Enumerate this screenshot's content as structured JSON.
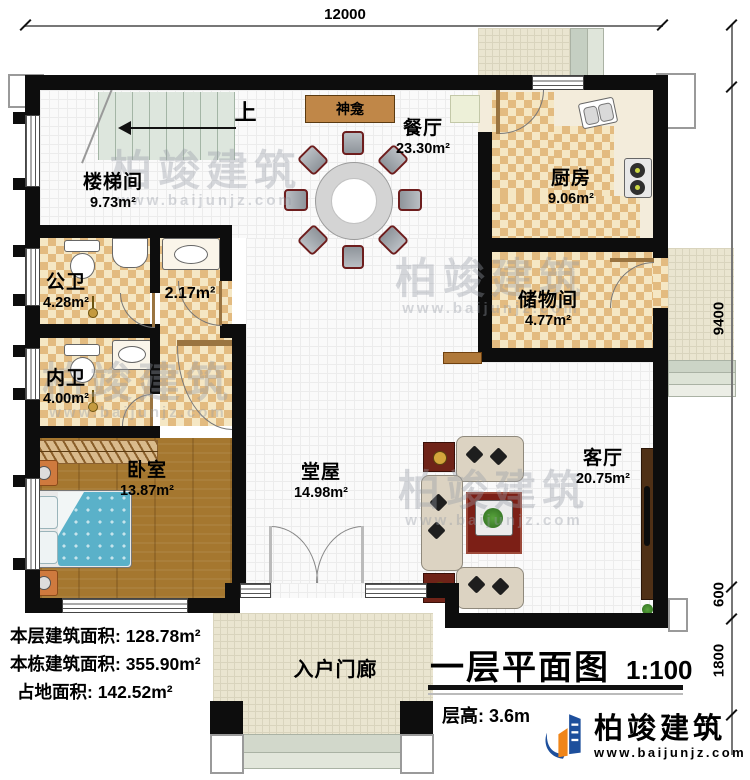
{
  "plan": {
    "title": "一层平面图",
    "scale": "1:100",
    "storey_height_label": "层高:",
    "storey_height_value": "3.6m",
    "up_label": "上",
    "shrine_label": "神龛"
  },
  "dimensions": {
    "top": "12000",
    "right_upper": "9400",
    "right_middle": "600",
    "right_lower": "1800"
  },
  "rooms": [
    {
      "name": "楼梯间",
      "area": "9.73m²"
    },
    {
      "name": "餐厅",
      "area": "23.30m²"
    },
    {
      "name": "厨房",
      "area": "9.06m²"
    },
    {
      "name": "公卫",
      "area": "4.28m²"
    },
    {
      "name": "",
      "area": "2.17m²"
    },
    {
      "name": "储物间",
      "area": "4.77m²"
    },
    {
      "name": "内卫",
      "area": "4.00m²"
    },
    {
      "name": "卧室",
      "area": "13.87m²"
    },
    {
      "name": "堂屋",
      "area": "14.98m²"
    },
    {
      "name": "客厅",
      "area": "20.75m²"
    },
    {
      "name": "入户门廊",
      "area": ""
    }
  ],
  "areas_summary": {
    "rows": [
      {
        "label": "本层建筑面积:",
        "value": "128.78m²"
      },
      {
        "label": "本栋建筑面积:",
        "value": "355.90m²"
      },
      {
        "label": "占地面积:",
        "value": "142.52m²"
      }
    ]
  },
  "brand": {
    "name": "柏竣建筑",
    "website": "www.baijunjz.com"
  },
  "watermark": {
    "name": "柏竣建筑",
    "website": "www.baijunjz.com"
  },
  "colors": {
    "wall": "#0d0d0d",
    "checker_dark": "#e3bb80",
    "checker_light": "#f5e7c4",
    "wood_floor": "#a5772f",
    "bed_quilt": "#5ab1c9",
    "porch_tile": "#eae5d0",
    "brand_blue": "#1d4f9c",
    "brand_orange": "#f08519"
  }
}
